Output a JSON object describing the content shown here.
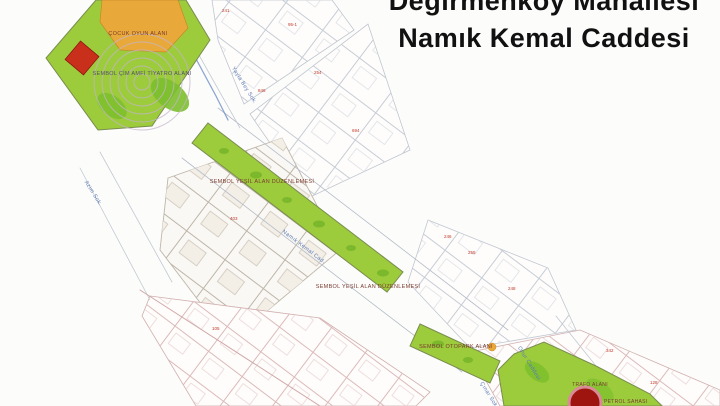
{
  "title": {
    "line1": "Değirmenköy Mahallesi",
    "line2": "Namık Kemal Caddesi"
  },
  "map": {
    "park": {
      "playground_label": "ÇOCUK OYUN ALANI",
      "amphitheater_label": "SEMBOL ÇİM AMFİ TİYATRO ALANI"
    },
    "green_strip": {
      "label_upper": "SEMBOL YEŞİL ALAN DÜZENLEMESİ",
      "label_lower": "SEMBOL YEŞİL ALAN DÜZENLEMESİ",
      "label_end": "SEMBOL OTOPARK ALANI"
    },
    "facility": {
      "label_trafo": "TRAFO ALANI",
      "label_petrol": "PETROL SAHASI"
    },
    "streets": [
      {
        "name": "Yayla Bey Sok."
      },
      {
        "name": "Azim Sok."
      },
      {
        "name": "Namık Kemal Cad."
      },
      {
        "name": "Onur Caddesi"
      },
      {
        "name": "Çınar Sok."
      }
    ],
    "parcel_numbers": [
      {
        "value": "846"
      },
      {
        "value": "241"
      },
      {
        "value": "254"
      },
      {
        "value": "694"
      },
      {
        "value": "255"
      },
      {
        "value": "248"
      },
      {
        "value": "246"
      },
      {
        "value": "105"
      },
      {
        "value": "342"
      },
      {
        "value": "128"
      },
      {
        "value": "403"
      },
      {
        "value": "95-1"
      }
    ]
  },
  "colors": {
    "park_green": "#9CCB3C",
    "dark_green": "#7CBF2C",
    "playground_orange": "#E9A93A",
    "symbol_red": "#C8301C",
    "facility_red": "#9E1510",
    "facility_ring": "#D98A96",
    "street_label_blue": "#5B7AB5",
    "parcel_gray": "#C6CCD6",
    "parcel_pink": "#DBBABA",
    "parcel_tan": "#BDB5A8",
    "label_dark_red": "#7A3B2F",
    "number_red": "#C0392B"
  }
}
